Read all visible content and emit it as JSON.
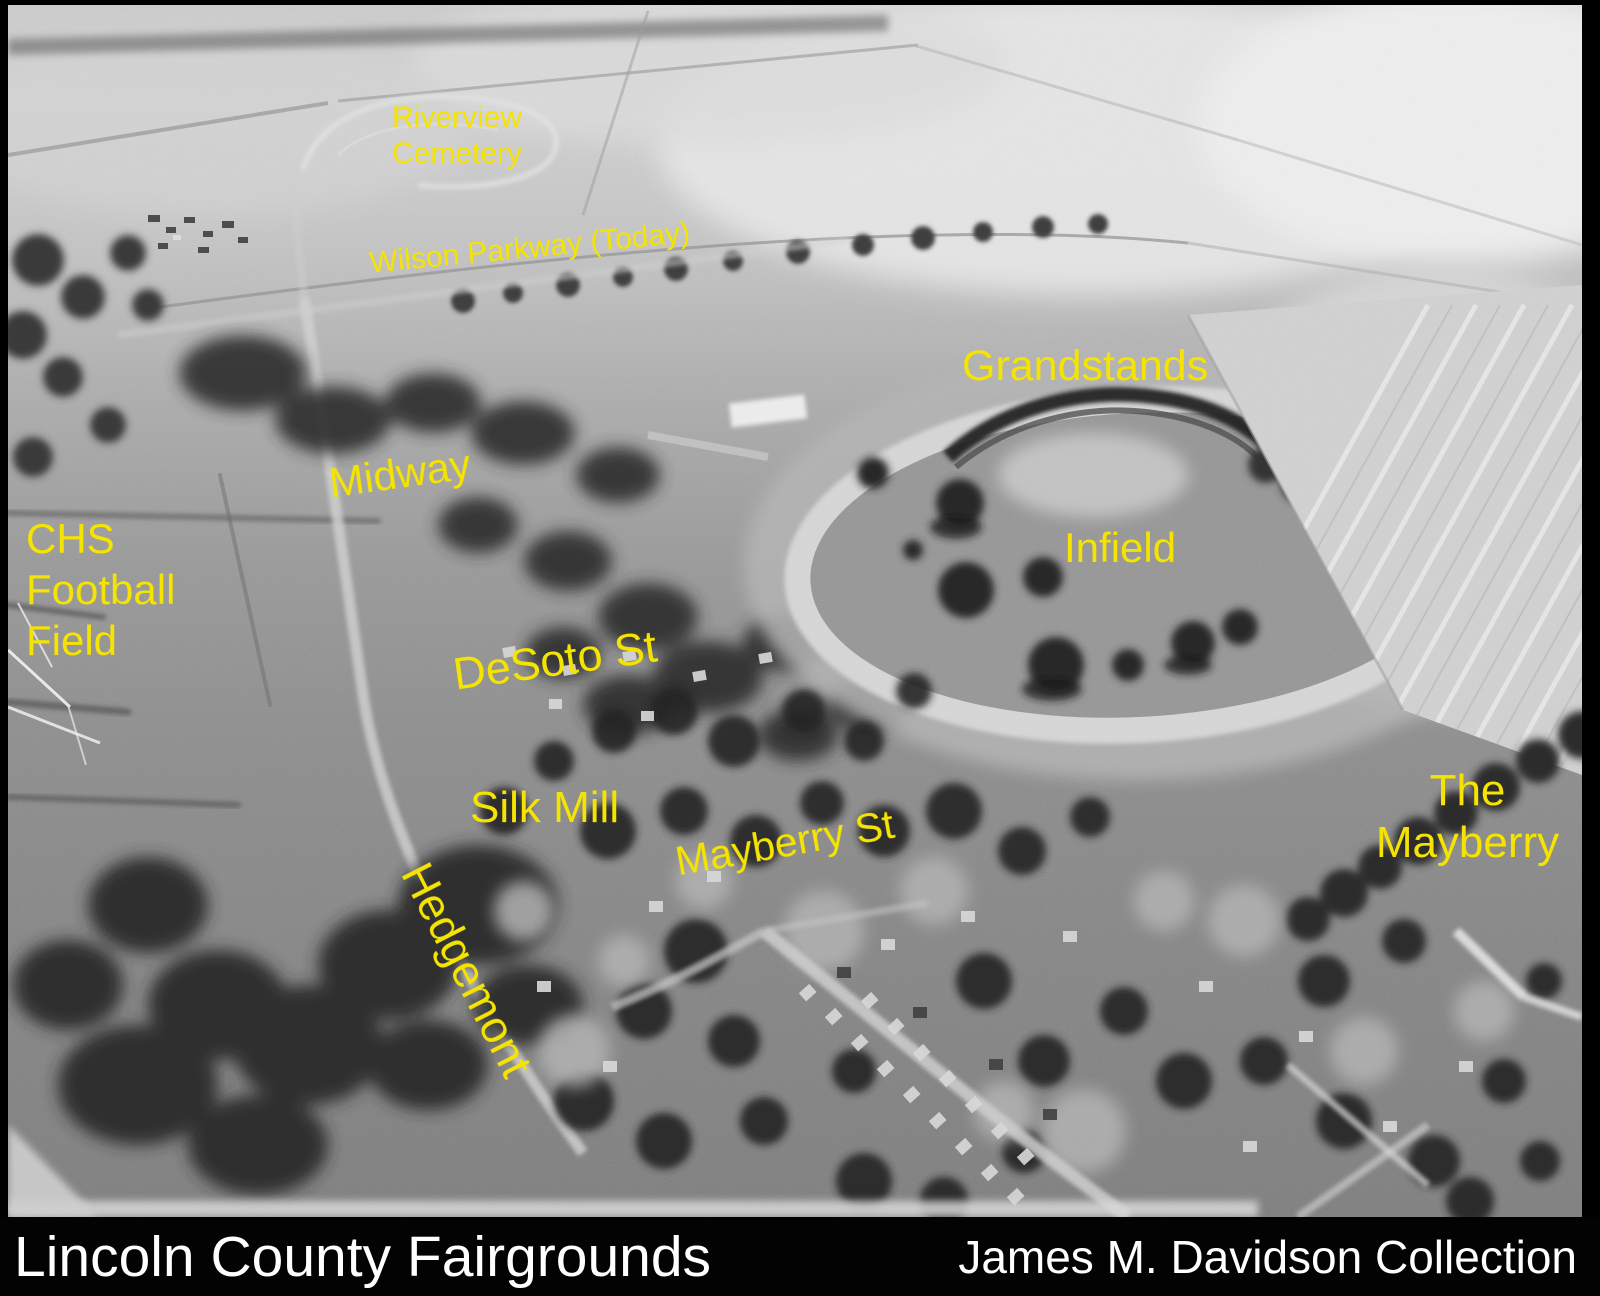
{
  "colors": {
    "label_yellow": "#f5e300",
    "caption_white": "#ffffff",
    "frame_black": "#000000"
  },
  "photo_labels": {
    "riverview_cemetery": {
      "line1": "Riverview",
      "line2": "Cemetery"
    },
    "wilson_parkway": "Wilson Parkway (Today)",
    "grandstands": "Grandstands",
    "midway": "Midway",
    "chs_football_field": {
      "line1": "CHS",
      "line2": "Football",
      "line3": "Field"
    },
    "infield": "Infield",
    "desoto_st": "DeSoto St",
    "silk_mill": "Silk Mill",
    "mayberry_st": "Mayberry St",
    "hedgemont": "Hedgemont",
    "the_mayberry": {
      "line1": "The",
      "line2": "Mayberry"
    }
  },
  "caption_bar": {
    "title": "Lincoln County Fairgrounds",
    "credit": "James M. Davidson Collection"
  }
}
